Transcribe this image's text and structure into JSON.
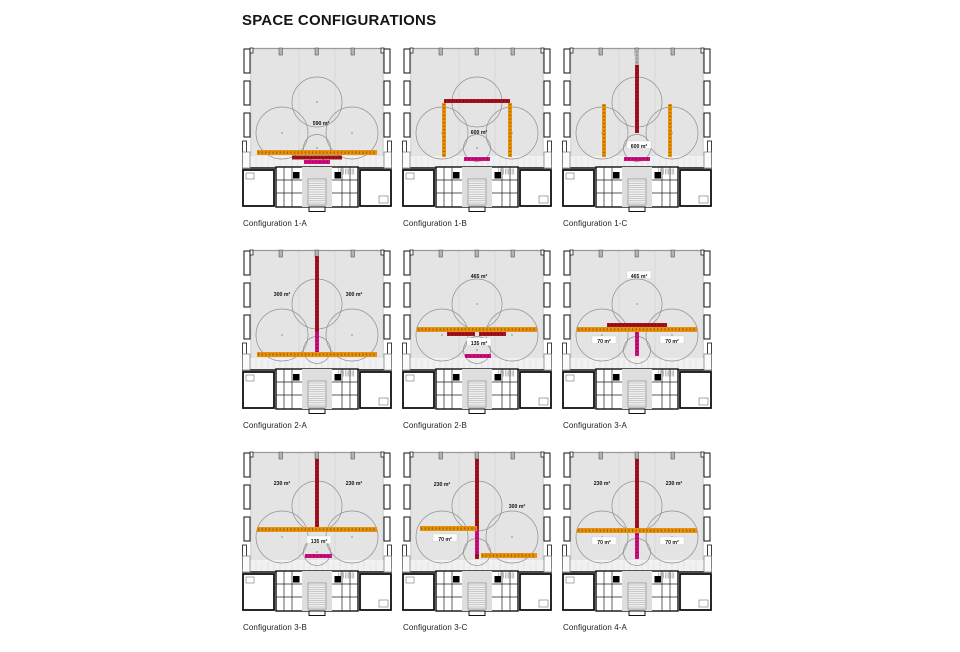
{
  "title": "SPACE CONFIGURATIONS",
  "colors": {
    "hall": "#E4E4E4",
    "strip": "#F1F1F1",
    "line": "#8F8F8F",
    "orange": "#E8920C",
    "orange_dark": "#9A6100",
    "red": "#A6131F",
    "red_dark": "#6E0A12",
    "magenta": "#CE0F7D",
    "magenta_dark": "#8C0A55",
    "gray": "#B5B5B5",
    "gray_dark": "#8A8A8A"
  },
  "configurations": [
    {
      "label": "Configuration 1-A",
      "areas": [
        {
          "text": "590 m²",
          "x": 79,
          "y": 77,
          "box": false
        }
      ],
      "bars": [
        {
          "color": "orange",
          "x": 15,
          "y": 104,
          "w": 120,
          "h": 5
        },
        {
          "color": "red",
          "x": 50,
          "y": 109.5,
          "w": 50,
          "h": 4
        },
        {
          "color": "magenta",
          "x": 62,
          "y": 114,
          "w": 26,
          "h": 4
        }
      ]
    },
    {
      "label": "Configuration 1-B",
      "areas": [
        {
          "text": "600 m²",
          "x": 77,
          "y": 86,
          "box": false
        }
      ],
      "bars": [
        {
          "color": "red",
          "x": 42,
          "y": 53,
          "w": 66,
          "h": 4
        },
        {
          "color": "orange",
          "x": 40,
          "y": 57,
          "w": 4,
          "h": 54
        },
        {
          "color": "orange",
          "x": 106,
          "y": 57,
          "w": 4,
          "h": 54
        },
        {
          "color": "magenta",
          "x": 62,
          "y": 111,
          "w": 26,
          "h": 4
        }
      ]
    },
    {
      "label": "Configuration 1-C",
      "areas": [
        {
          "text": "600 m²",
          "x": 77,
          "y": 100,
          "box": true
        }
      ],
      "bars": [
        {
          "color": "gray",
          "x": 73,
          "y": 4,
          "w": 4,
          "h": 15
        },
        {
          "color": "red",
          "x": 73,
          "y": 19,
          "w": 4,
          "h": 68
        },
        {
          "color": "orange",
          "x": 40,
          "y": 58,
          "w": 4,
          "h": 53
        },
        {
          "color": "orange",
          "x": 106,
          "y": 58,
          "w": 4,
          "h": 53
        },
        {
          "color": "magenta",
          "x": 62,
          "y": 111,
          "w": 26,
          "h": 4
        }
      ]
    },
    {
      "label": "Configuration 2-A",
      "areas": [
        {
          "text": "300 m²",
          "x": 40,
          "y": 46,
          "box": false
        },
        {
          "text": "300 m²",
          "x": 112,
          "y": 46,
          "box": false
        }
      ],
      "bars": [
        {
          "color": "red",
          "x": 73,
          "y": 8,
          "w": 4,
          "h": 76
        },
        {
          "color": "magenta",
          "x": 73,
          "y": 84,
          "w": 4,
          "h": 21
        },
        {
          "color": "orange",
          "x": 15,
          "y": 104,
          "w": 120,
          "h": 5
        }
      ]
    },
    {
      "label": "Configuration 2-B",
      "areas": [
        {
          "text": "465 m²",
          "x": 77,
          "y": 28,
          "box": false
        },
        {
          "text": "135 m²",
          "x": 77,
          "y": 95,
          "box": true
        }
      ],
      "bars": [
        {
          "color": "orange",
          "x": 15,
          "y": 79,
          "w": 120,
          "h": 5
        },
        {
          "color": "red",
          "x": 45,
          "y": 84,
          "w": 28,
          "h": 4
        },
        {
          "color": "red",
          "x": 77,
          "y": 84,
          "w": 27,
          "h": 4
        },
        {
          "color": "magenta",
          "x": 63,
          "y": 106,
          "w": 26,
          "h": 4
        }
      ]
    },
    {
      "label": "Configuration 3-A",
      "areas": [
        {
          "text": "465 m²",
          "x": 77,
          "y": 28,
          "box": true
        },
        {
          "text": "70 m²",
          "x": 42,
          "y": 93,
          "box": true
        },
        {
          "text": "70 m²",
          "x": 110,
          "y": 93,
          "box": true
        }
      ],
      "bars": [
        {
          "color": "magenta",
          "x": 73,
          "y": 84,
          "w": 4,
          "h": 24
        },
        {
          "color": "orange",
          "x": 15,
          "y": 79,
          "w": 120,
          "h": 5
        },
        {
          "color": "red",
          "x": 45,
          "y": 75,
          "w": 60,
          "h": 4
        }
      ]
    },
    {
      "label": "Configuration 3-B",
      "areas": [
        {
          "text": "230 m²",
          "x": 40,
          "y": 33,
          "box": false
        },
        {
          "text": "230 m²",
          "x": 112,
          "y": 33,
          "box": false
        },
        {
          "text": "135 m²",
          "x": 77,
          "y": 91,
          "box": true
        }
      ],
      "bars": [
        {
          "color": "red",
          "x": 73,
          "y": 9,
          "w": 4,
          "h": 69
        },
        {
          "color": "orange",
          "x": 15,
          "y": 77,
          "w": 120,
          "h": 5
        },
        {
          "color": "magenta",
          "x": 63,
          "y": 104,
          "w": 27,
          "h": 4
        }
      ]
    },
    {
      "label": "Configuration 3-C",
      "areas": [
        {
          "text": "230 m²",
          "x": 40,
          "y": 34,
          "box": false
        },
        {
          "text": "300 m²",
          "x": 115,
          "y": 56,
          "box": false
        },
        {
          "text": "70 m²",
          "x": 43,
          "y": 89,
          "box": true
        }
      ],
      "bars": [
        {
          "color": "red",
          "x": 73,
          "y": 9,
          "w": 4,
          "h": 70
        },
        {
          "color": "magenta",
          "x": 73,
          "y": 79,
          "w": 4,
          "h": 25
        },
        {
          "color": "red",
          "x": 73,
          "y": 104,
          "w": 4,
          "h": 5
        },
        {
          "color": "orange",
          "x": 18,
          "y": 76,
          "w": 57,
          "h": 5
        },
        {
          "color": "orange",
          "x": 79,
          "y": 103,
          "w": 56,
          "h": 5
        }
      ]
    },
    {
      "label": "Configuration 4-A",
      "areas": [
        {
          "text": "230 m²",
          "x": 40,
          "y": 33,
          "box": false
        },
        {
          "text": "230 m²",
          "x": 112,
          "y": 33,
          "box": false
        },
        {
          "text": "70 m²",
          "x": 42,
          "y": 92,
          "box": true
        },
        {
          "text": "70 m²",
          "x": 110,
          "y": 92,
          "box": true
        }
      ],
      "bars": [
        {
          "color": "red",
          "x": 73,
          "y": 9,
          "w": 4,
          "h": 70
        },
        {
          "color": "magenta",
          "x": 73,
          "y": 83,
          "w": 4,
          "h": 26
        },
        {
          "color": "orange",
          "x": 15,
          "y": 78,
          "w": 120,
          "h": 5
        }
      ]
    }
  ]
}
